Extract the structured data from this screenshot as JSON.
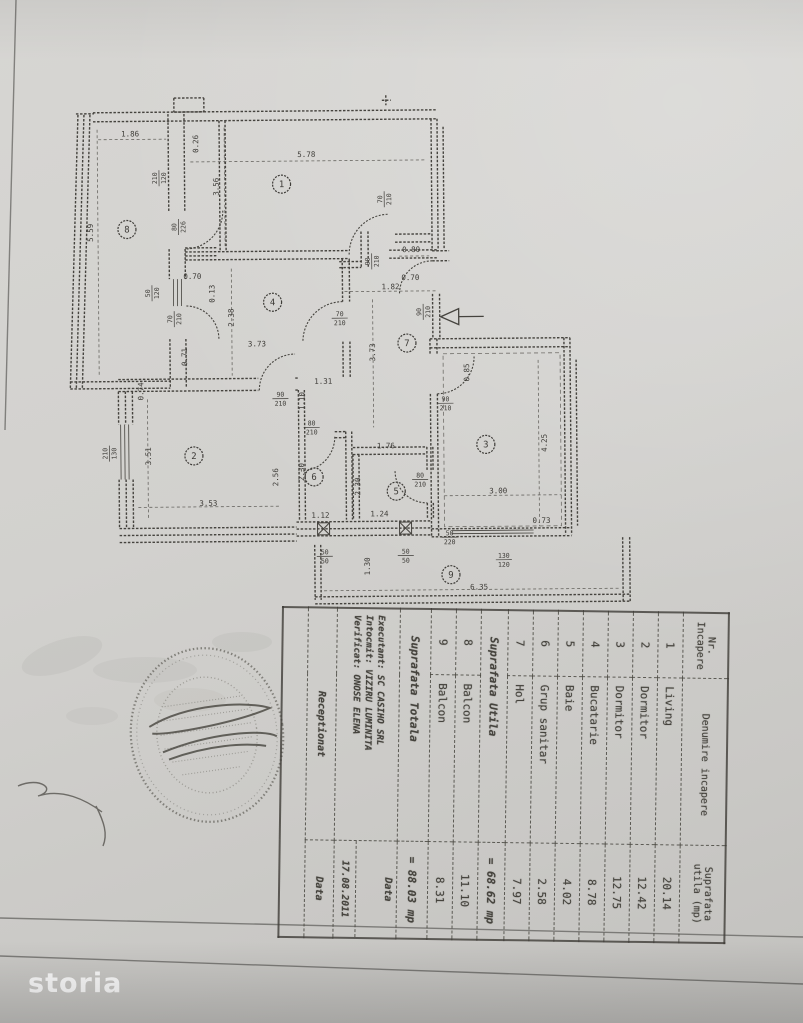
{
  "page": {
    "watermark": "storia"
  },
  "colors": {
    "paper": "#d2d1ce",
    "ink": "#45433e",
    "dim_ink": "#55534e",
    "stamp_ink": "#67655f",
    "watermark_text": "#ffffff"
  },
  "table": {
    "header": {
      "col1": [
        "Nr.",
        "Incapere"
      ],
      "col2": "Denumire incapere",
      "col3": [
        "Suprafata",
        "utila (mp)"
      ]
    },
    "rooms": [
      {
        "nr": "1",
        "name": "Living",
        "area": "20.14"
      },
      {
        "nr": "2",
        "name": "Dormitor",
        "area": "12.42"
      },
      {
        "nr": "3",
        "name": "Dormitor",
        "area": "12.75"
      },
      {
        "nr": "4",
        "name": "Bucatarie",
        "area": "8.78"
      },
      {
        "nr": "5",
        "name": "Baie",
        "area": "4.02"
      },
      {
        "nr": "6",
        "name": "Grup sanitar",
        "area": "2.58"
      },
      {
        "nr": "7",
        "name": "Hol",
        "area": "7.97"
      }
    ],
    "subtotal": {
      "label": "Suprafata Utila",
      "value": "= 68.62 mp"
    },
    "balconies": [
      {
        "nr": "8",
        "name": "Balcon",
        "area": "11.10"
      },
      {
        "nr": "9",
        "name": "Balcon",
        "area": "8.31"
      }
    ],
    "total": {
      "label": "Suprafata Totala",
      "value": "= 88.03 mp"
    },
    "footer": {
      "lines": [
        "Executant: SC CASIHO SRL",
        "Intocmit: VIZIRU LUMINITA",
        "Verificat: ONOSE ELENA"
      ],
      "data_label": "Data",
      "date": "17.08.2011",
      "receptionat": "Receptionat",
      "data_label2": "Data"
    }
  },
  "plan": {
    "rooms": [
      {
        "n": "1",
        "x": 283,
        "y": 184
      },
      {
        "n": "2",
        "x": 193,
        "y": 455
      },
      {
        "n": "3",
        "x": 485,
        "y": 446
      },
      {
        "n": "4",
        "x": 273,
        "y": 302
      },
      {
        "n": "5",
        "x": 395,
        "y": 492
      },
      {
        "n": "6",
        "x": 313,
        "y": 477
      },
      {
        "n": "7",
        "x": 407,
        "y": 344
      },
      {
        "n": "8",
        "x": 128,
        "y": 228
      },
      {
        "n": "9",
        "x": 449,
        "y": 576
      }
    ],
    "dims": [
      {
        "t": "5.78",
        "x": 308,
        "y": 157,
        "r": 0
      },
      {
        "t": "3.56",
        "x": 220,
        "y": 186,
        "r": 1
      },
      {
        "t": "1.86",
        "x": 132,
        "y": 135,
        "r": 0
      },
      {
        "t": "5.59",
        "x": 94,
        "y": 231,
        "r": 1
      },
      {
        "t": "0.26",
        "x": 200,
        "y": 143,
        "r": 1
      },
      {
        "t": "0.80",
        "x": 412,
        "y": 253,
        "r": 0
      },
      {
        "t": "0.70",
        "x": 411,
        "y": 281,
        "r": 0
      },
      {
        "t": "1.82",
        "x": 391,
        "y": 290,
        "r": 0
      },
      {
        "t": "0.70",
        "x": 193,
        "y": 278,
        "r": 0
      },
      {
        "t": "0.13",
        "x": 215,
        "y": 293,
        "r": 1
      },
      {
        "t": "2.38",
        "x": 234,
        "y": 317,
        "r": 1
      },
      {
        "t": "3.73",
        "x": 257,
        "y": 346,
        "r": 0
      },
      {
        "t": "0.71",
        "x": 187,
        "y": 356,
        "r": 1
      },
      {
        "t": "0.74",
        "x": 143,
        "y": 390,
        "r": 1
      },
      {
        "t": "1.31",
        "x": 323,
        "y": 384,
        "r": 0
      },
      {
        "t": "1.10",
        "x": 304,
        "y": 401,
        "r": 1
      },
      {
        "t": "3.73",
        "x": 375,
        "y": 353,
        "r": 1
      },
      {
        "t": "0.85",
        "x": 469,
        "y": 374,
        "r": 1
      },
      {
        "t": "3.51",
        "x": 150,
        "y": 455,
        "r": 1
      },
      {
        "t": "3.53",
        "x": 207,
        "y": 505,
        "r": 0
      },
      {
        "t": "2.56",
        "x": 277,
        "y": 477,
        "r": 1
      },
      {
        "t": "2.30",
        "x": 303,
        "y": 472,
        "r": 1
      },
      {
        "t": "1.12",
        "x": 319,
        "y": 518,
        "r": 0
      },
      {
        "t": "2.30",
        "x": 359,
        "y": 487,
        "r": 1
      },
      {
        "t": "1.76",
        "x": 385,
        "y": 449,
        "r": 0
      },
      {
        "t": "1.24",
        "x": 378,
        "y": 517,
        "r": 0
      },
      {
        "t": "4.25",
        "x": 546,
        "y": 445,
        "r": 1
      },
      {
        "t": "3.00",
        "x": 497,
        "y": 495,
        "r": 0
      },
      {
        "t": "0.73",
        "x": 540,
        "y": 525,
        "r": 0
      },
      {
        "t": "6.35",
        "x": 477,
        "y": 591,
        "r": 0
      },
      {
        "t": "1.30",
        "x": 368,
        "y": 567,
        "r": 1
      }
    ],
    "specs": [
      {
        "a": "90",
        "b": "210",
        "x": 372,
        "y": 262,
        "r": 1
      },
      {
        "a": "90",
        "b": "210",
        "x": 423,
        "y": 313,
        "r": 1
      },
      {
        "a": "70",
        "b": "210",
        "x": 340,
        "y": 318,
        "r": 0
      },
      {
        "a": "70",
        "b": "210",
        "x": 385,
        "y": 200,
        "r": 1
      },
      {
        "a": "90",
        "b": "210",
        "x": 280,
        "y": 398,
        "r": 0
      },
      {
        "a": "80",
        "b": "210",
        "x": 311,
        "y": 427,
        "r": 0
      },
      {
        "a": "80",
        "b": "210",
        "x": 419,
        "y": 480,
        "r": 0
      },
      {
        "a": "90",
        "b": "210",
        "x": 445,
        "y": 404,
        "r": 0
      },
      {
        "a": "50",
        "b": "220",
        "x": 448,
        "y": 538,
        "r": 0
      },
      {
        "a": "130",
        "b": "120",
        "x": 502,
        "y": 561,
        "r": 0
      },
      {
        "a": "50",
        "b": "50",
        "x": 323,
        "y": 556,
        "r": 0
      },
      {
        "a": "50",
        "b": "50",
        "x": 404,
        "y": 556,
        "r": 0
      },
      {
        "a": "210",
        "b": "130",
        "x": 108,
        "y": 452,
        "r": 1
      },
      {
        "a": "210",
        "b": "120",
        "x": 160,
        "y": 177,
        "r": 1
      },
      {
        "a": "80",
        "b": "226",
        "x": 179,
        "y": 226,
        "r": 1
      },
      {
        "a": "50",
        "b": "120",
        "x": 152,
        "y": 292,
        "r": 1
      },
      {
        "a": "70",
        "b": "210",
        "x": 174,
        "y": 318,
        "r": 1
      }
    ]
  }
}
